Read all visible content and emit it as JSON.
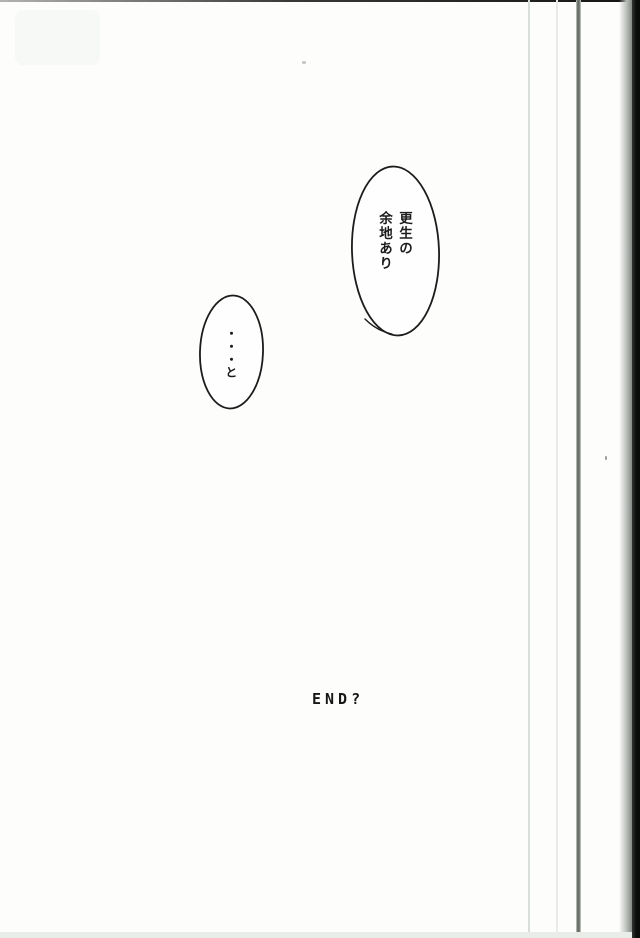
{
  "page": {
    "background": "#fdfdfc",
    "ink": "#1c1c1c"
  },
  "colors": {
    "page_edge_line_light": "#d9ded9",
    "page_edge_line_faint": "#e8ebe8",
    "binding_line": "#646a62",
    "scan_edge_black": "#0a0c0a",
    "bottom_strip": "#e9ece9"
  },
  "bubbles": [
    {
      "text": "更生の\n余地あり"
    },
    {
      "text": "・・・と"
    }
  ],
  "end_label": "END?"
}
